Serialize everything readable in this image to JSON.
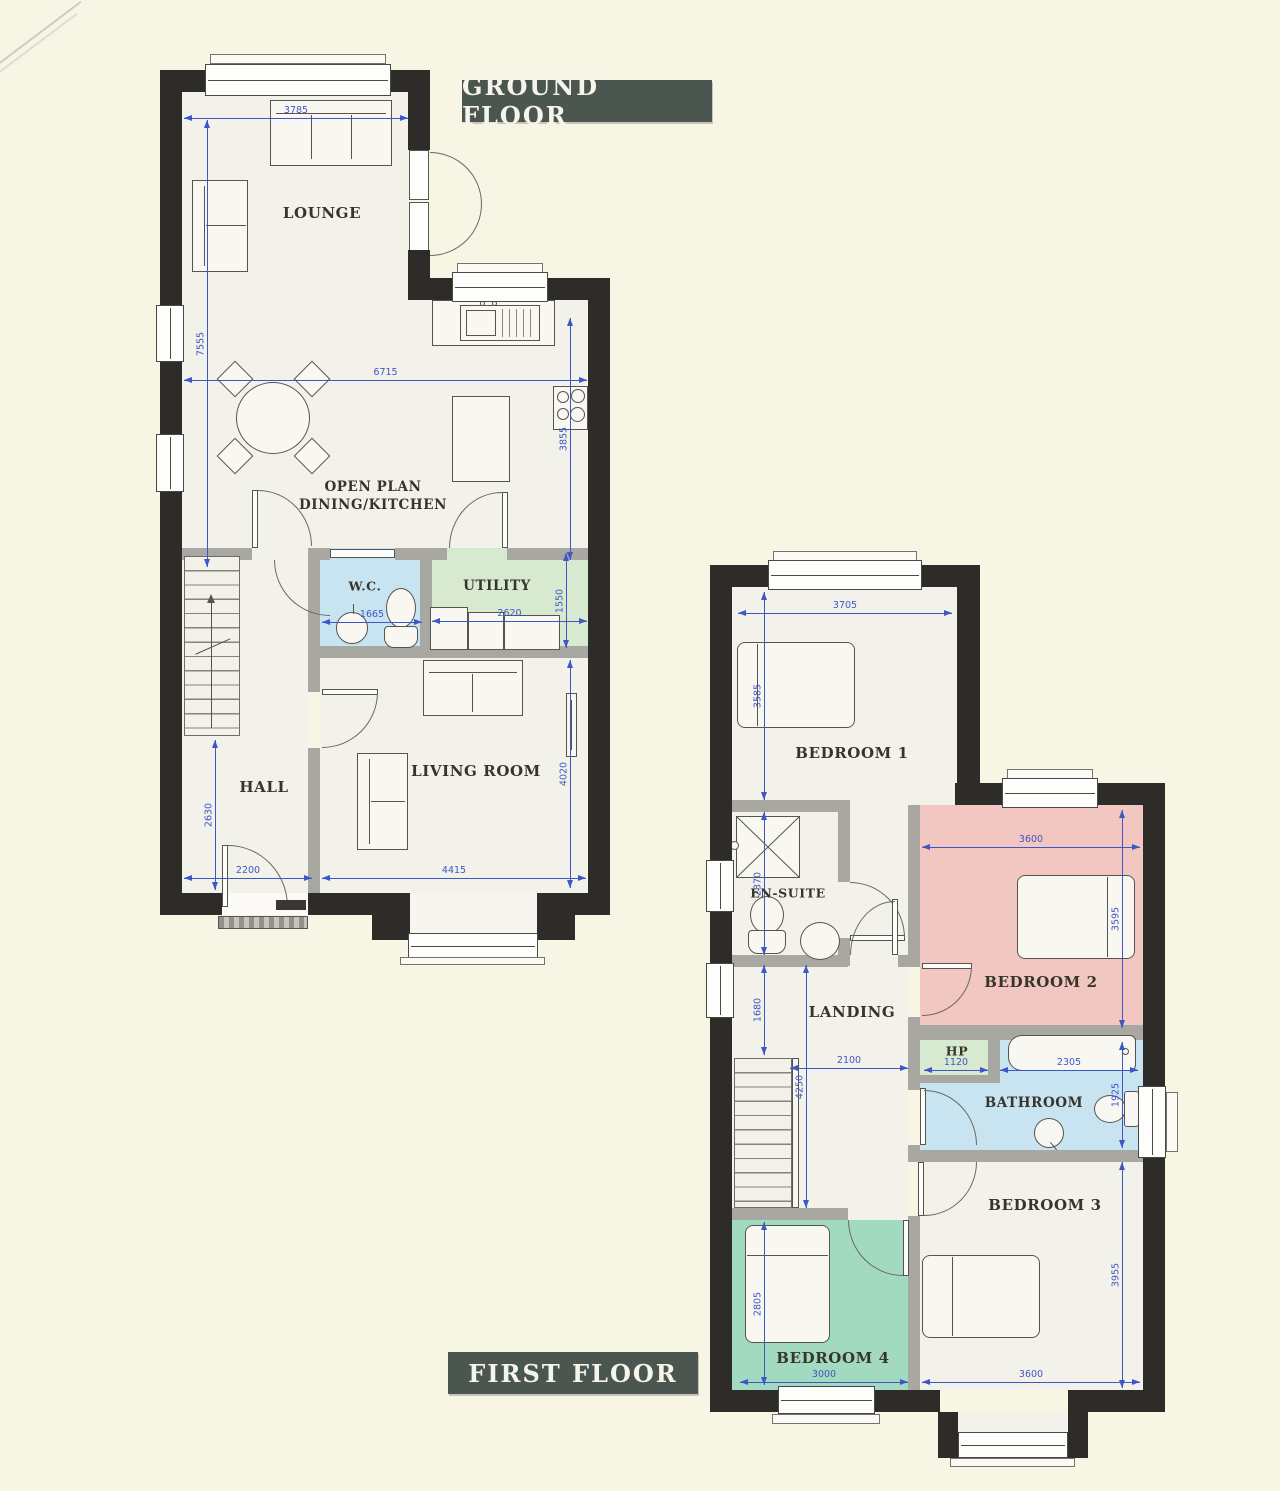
{
  "ground_floor": {
    "badge": "GROUND FLOOR",
    "lounge": {
      "label": "LOUNGE",
      "width_mm": "3785",
      "height_mm": "7555"
    },
    "dining_kitchen": {
      "label_line1": "OPEN PLAN",
      "label_line2": "DINING/KITCHEN",
      "width_mm": "6715",
      "height_mm": "3855"
    },
    "wc": {
      "label": "W.C.",
      "width_mm": "1665"
    },
    "utility": {
      "label": "UTILITY",
      "width_mm": "2620",
      "height_mm": "1550"
    },
    "hall": {
      "label": "HALL",
      "width_mm": "2200",
      "height_mm": "2630"
    },
    "living_room": {
      "label": "LIVING ROOM",
      "width_mm": "4415",
      "height_mm": "4020"
    }
  },
  "first_floor": {
    "badge": "FIRST FLOOR",
    "bedroom1": {
      "label": "BEDROOM 1",
      "width_mm": "3705",
      "height_mm": "3585"
    },
    "ensuite": {
      "label": "EN-SUITE",
      "height_mm": "2370"
    },
    "bedroom2": {
      "label": "BEDROOM 2",
      "width_mm": "3600",
      "height_mm": "3595"
    },
    "landing": {
      "label": "LANDING",
      "width_mm": "2100",
      "height_mm": "4250",
      "upper_height_mm": "1680"
    },
    "hp": {
      "label": "HP",
      "width_mm": "1120"
    },
    "bathroom": {
      "label": "BATHROOM",
      "bath_width_mm": "2305",
      "height_mm": "1925"
    },
    "bedroom3": {
      "label": "BEDROOM 3",
      "width_mm": "3600",
      "height_mm": "3955"
    },
    "bedroom4": {
      "label": "BEDROOM 4",
      "width_mm": "3000",
      "height_mm": "2805"
    }
  },
  "colors": {
    "wall": "#2e2c28",
    "dimension_blue": "#3f57c6",
    "badge_bg": "#4b5650",
    "wc_blue": "#c9e4f1",
    "utility_green": "#d7e9cf",
    "bedroom2_pink": "#f2c6c1",
    "bedroom4_teal": "#a2dac1"
  }
}
